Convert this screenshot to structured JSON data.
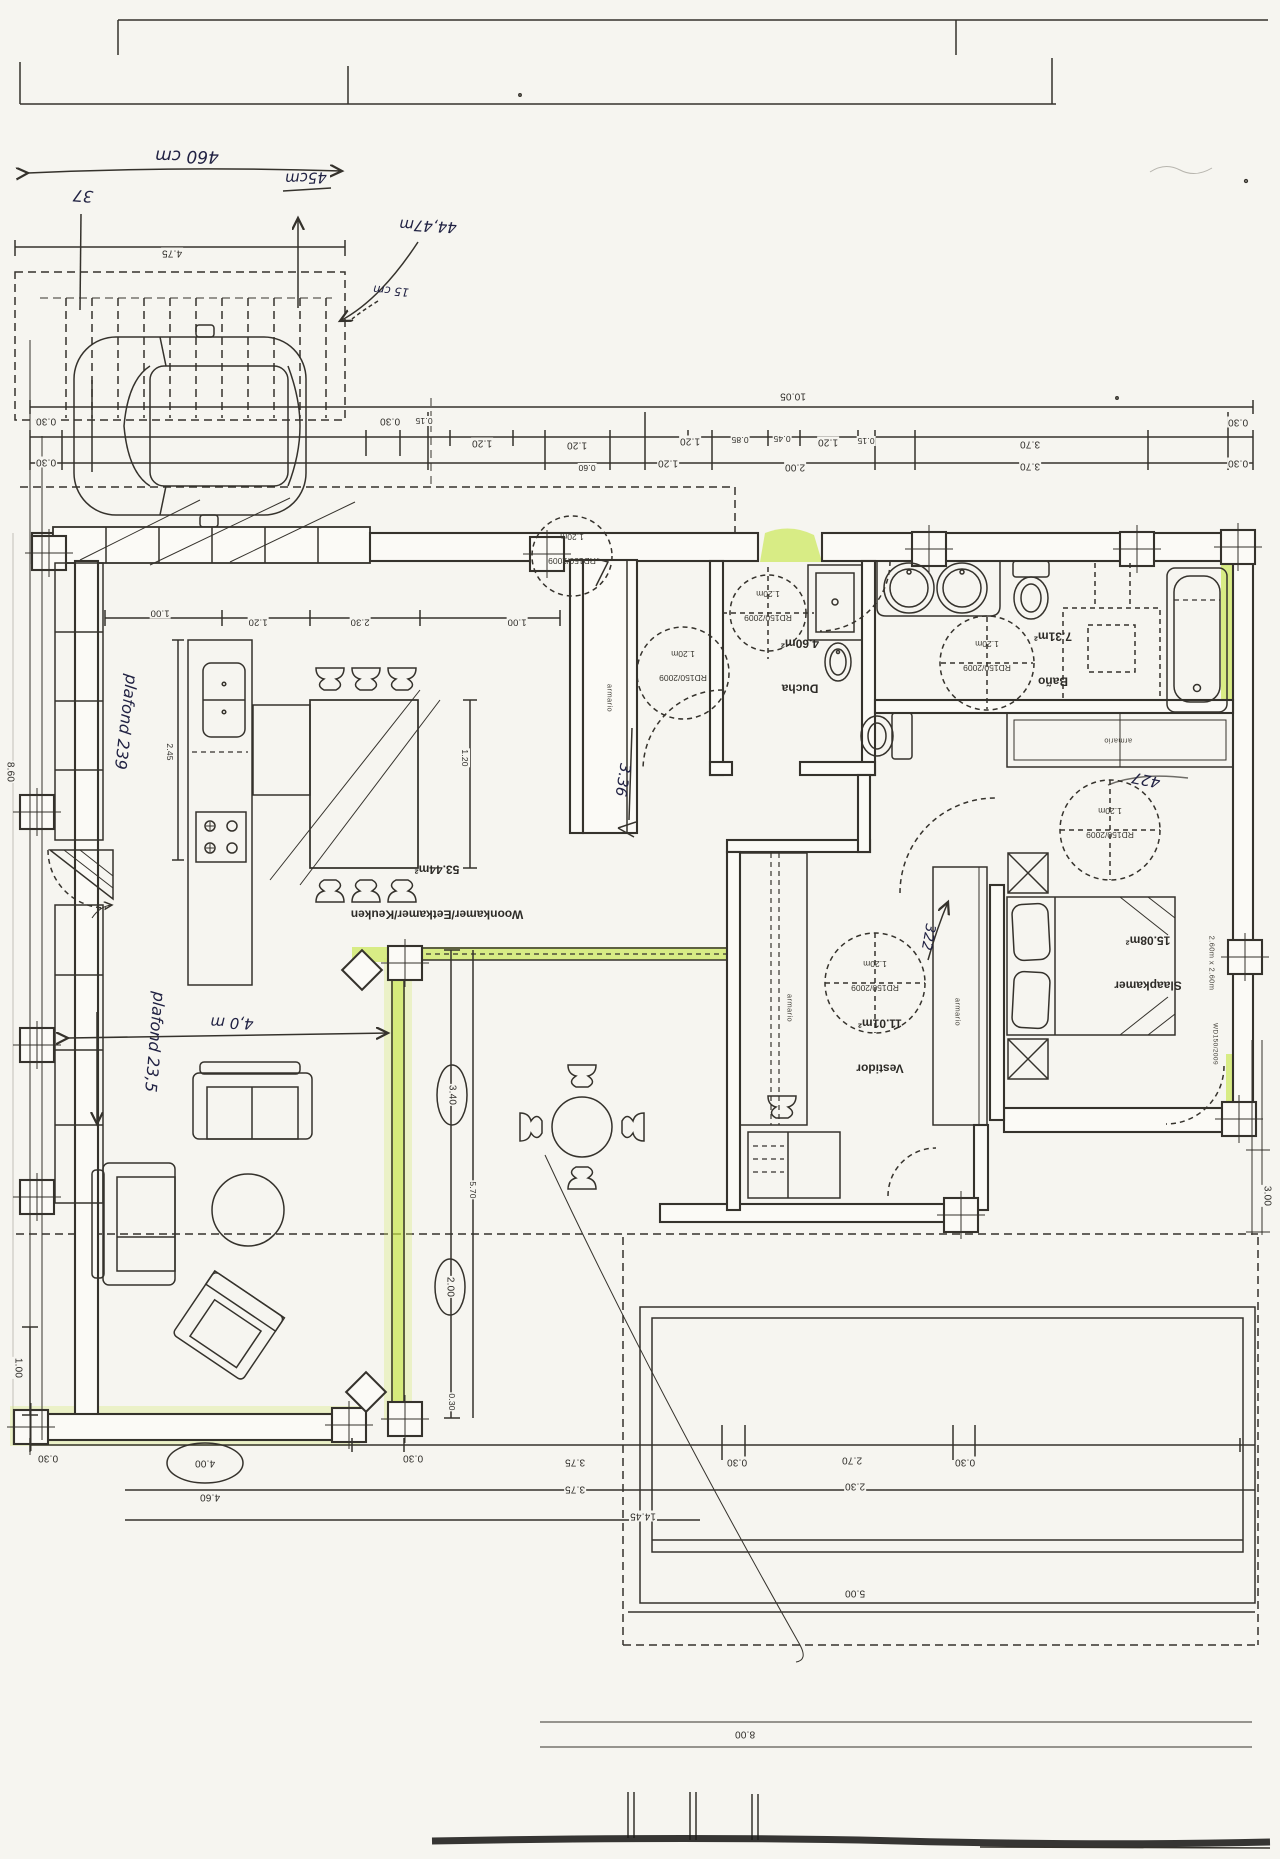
{
  "rooms": {
    "living": {
      "name": "Woonkamer/Eetkamer/Keuken",
      "area": "53.44m²"
    },
    "shower": {
      "name": "Ducha",
      "area": "4.60m²"
    },
    "bathroom": {
      "name": "Baño",
      "area": "7.31m²"
    },
    "bedroom": {
      "name": "Slaapkamer",
      "area": "15.08m²"
    },
    "dressing": {
      "name": "Vestidor",
      "area": "11.01m²"
    }
  },
  "labels": {
    "closet": "armario",
    "norm_code": "RD150/2009",
    "norm_diameter": "1.20m",
    "bed_size": "2.60m x 2.60m",
    "bed_code": "WD150/2009"
  },
  "handwritten": {
    "carport_width": "460 cm",
    "carport_offset": "45cm",
    "carport_37": "37",
    "carport_height": "44,47m",
    "carport_15": "15 cm",
    "ceiling_kitchen": "plafond 239",
    "ceiling_living": "plafond 23,5",
    "living_width": "4,0 m",
    "hall_length": "3.36",
    "dressing_width": "322",
    "bedroom_width": "427"
  },
  "dims": {
    "top_total": "10.05",
    "carport_width": "4.75",
    "top_row1": [
      "0.30",
      "0.30",
      "0.15",
      "1.20",
      "1.20",
      "1.20",
      "0.85",
      "0.45",
      "1.20",
      "0.15",
      "3.70",
      "0.30"
    ],
    "top_row2": [
      "0.30",
      "0.60",
      "1.20",
      "2.00",
      "3.70",
      "0.30"
    ],
    "kitchen_row": [
      "1.00",
      "1.20",
      "2.30",
      "1.00"
    ],
    "kitchen_depth": "2.45",
    "island_width": "1.20",
    "terrace": {
      "w": "3.40",
      "w2": "2.00",
      "len": "5.70",
      "edge": "0.30"
    },
    "bottom_row": [
      "0.30",
      "4.00",
      "0.30",
      "4.60",
      "3.75",
      "3.75",
      "0.30",
      "2.70",
      "2.30",
      "0.30"
    ],
    "pool": {
      "side": "14.45",
      "width": "5.00",
      "bottom": "8.00"
    },
    "right_height": "3.00",
    "left_height": "8.60",
    "left_bottom": "1.00",
    "accessibility_circles": [
      "entrance",
      "hall",
      "shower",
      "bathroom",
      "bedroom",
      "dressing"
    ]
  }
}
